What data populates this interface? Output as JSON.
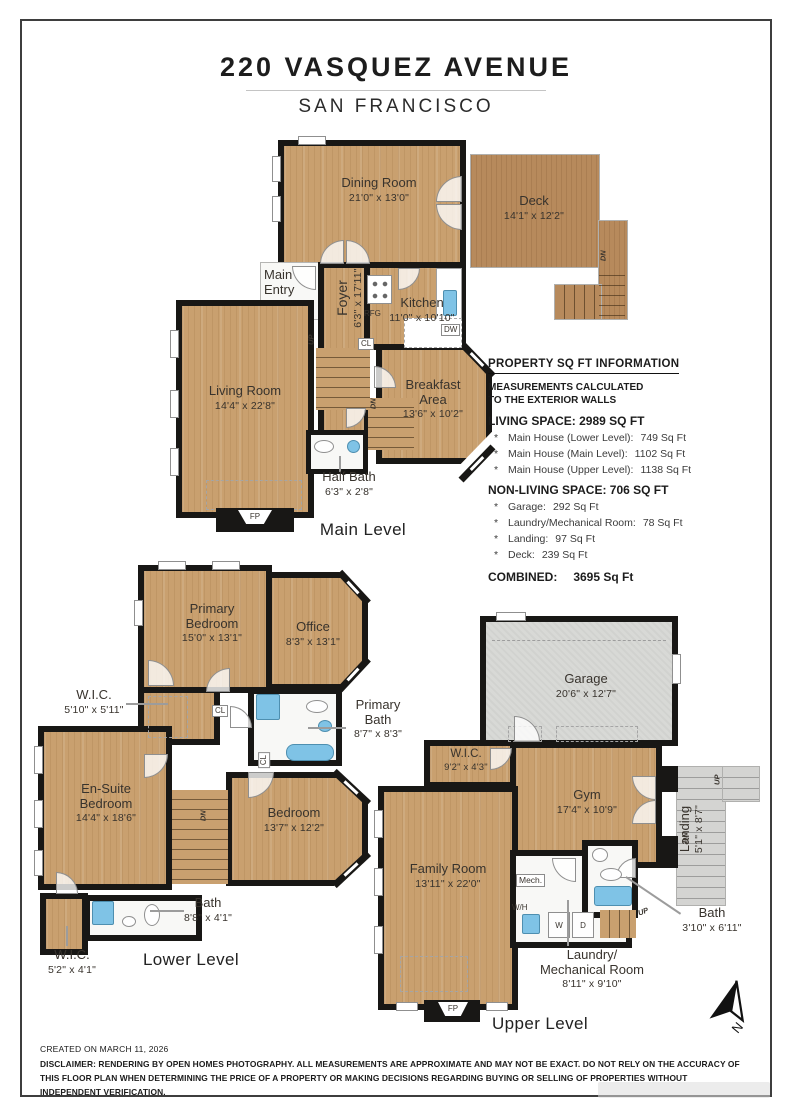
{
  "title": {
    "address": "220 VASQUEZ AVENUE",
    "city": "SAN FRANCISCO"
  },
  "colors": {
    "wood": "#c9a06f",
    "deck_wood": "#b78a5c",
    "wall": "#181715",
    "fixture_blue": "#7fc3e6",
    "garage_floor": "#d8d9d6"
  },
  "levels": {
    "main": {
      "caption": "Main Level",
      "dining": {
        "name": "Dining Room",
        "dims": "21'0\" x 13'0\""
      },
      "deck": {
        "name": "Deck",
        "dims": "14'1\" x 12'2\""
      },
      "entry": {
        "name": "Main Entry"
      },
      "foyer": {
        "name": "Foyer",
        "dims": "6'3\" x 17'11\""
      },
      "kitchen": {
        "name": "Kitchen",
        "dims": "11'0\" x 10'10\""
      },
      "breakfast": {
        "name": "Breakfast Area",
        "dims": "13'6\" x 10'2\""
      },
      "living": {
        "name": "Living Room",
        "dims": "14'4\" x 22'8\""
      },
      "halfbath": {
        "name": "Half Bath",
        "dims": "6'3\" x 2'8\""
      }
    },
    "lower": {
      "caption": "Lower Level",
      "primary_bedroom": {
        "name": "Primary Bedroom",
        "dims": "15'0\" x 13'1\""
      },
      "office": {
        "name": "Office",
        "dims": "8'3\" x 13'1\""
      },
      "wic1": {
        "name": "W.I.C.",
        "dims": "5'10\" x 5'11\""
      },
      "primary_bath": {
        "name": "Primary Bath",
        "dims": "8'7\" x 8'3\""
      },
      "ensuite": {
        "name": "En-Suite Bedroom",
        "dims": "14'4\" x 18'6\""
      },
      "bedroom": {
        "name": "Bedroom",
        "dims": "13'7\" x 12'2\""
      },
      "bath": {
        "name": "Bath",
        "dims": "8'8\" x 4'1\""
      },
      "wic2": {
        "name": "W.I.C.",
        "dims": "5'2\" x 4'1\""
      }
    },
    "upper": {
      "caption": "Upper Level",
      "garage": {
        "name": "Garage",
        "dims": "20'6\" x 12'7\""
      },
      "wic3": {
        "name": "W.I.C.",
        "dims": "9'2\" x 4'3\""
      },
      "gym": {
        "name": "Gym",
        "dims": "17'4\" x 10'9\""
      },
      "landing": {
        "name": "Landing",
        "dims": "5'1\" x 8'7\""
      },
      "family": {
        "name": "Family Room",
        "dims": "13'11\" x 22'0\""
      },
      "laundry": {
        "line1": "Laundry/",
        "line2": "Mechanical Room",
        "dims": "8'11\" x 9'10\""
      },
      "bath": {
        "name": "Bath",
        "dims": "3'10\" x 6'11\""
      }
    }
  },
  "sqft": {
    "header": "PROPERTY SQ FT INFORMATION",
    "note1": "MEASUREMENTS CALCULATED",
    "note2": "TO THE EXTERIOR WALLS",
    "living_title": "LIVING SPACE: 2989 SQ FT",
    "living_items": [
      {
        "label": "Main House (Lower Level):",
        "value": "749 Sq Ft"
      },
      {
        "label": "Main House (Main Level):",
        "value": "1102 Sq Ft"
      },
      {
        "label": "Main House (Upper Level):",
        "value": "1138 Sq Ft"
      }
    ],
    "nonliving_title": "NON-LIVING SPACE: 706 SQ FT",
    "nonliving_items": [
      {
        "label": "Garage:",
        "value": "292 Sq Ft"
      },
      {
        "label": "Laundry/Mechanical Room:",
        "value": "78 Sq Ft"
      },
      {
        "label": "Landing:",
        "value": "97 Sq Ft"
      },
      {
        "label": "Deck:",
        "value": "239 Sq Ft"
      }
    ],
    "combined_label": "COMBINED:",
    "combined_value": "3695  Sq Ft",
    "bullet": "*"
  },
  "tags": {
    "up": "UP",
    "dn": "DN",
    "cl": "CL",
    "dw": "DW",
    "rfg": "RFG",
    "fp": "FP",
    "mech": "Mech.",
    "wh": "W/H",
    "w": "W",
    "d": "D",
    "north": "N"
  },
  "footer": {
    "created": "CREATED ON MARCH 11, 2026",
    "disclaimer": "DISCLAIMER: RENDERING BY OPEN HOMES PHOTOGRAPHY. ALL MEASUREMENTS ARE APPROXIMATE AND MAY NOT BE EXACT. DO NOT RELY ON THE ACCURACY OF THIS FLOOR PLAN WHEN DETERMINING THE PRICE OF A PROPERTY OR MAKING DECISIONS REGARDING BUYING OR SELLING OF PROPERTIES WITHOUT INDEPENDENT VERIFICATION."
  }
}
